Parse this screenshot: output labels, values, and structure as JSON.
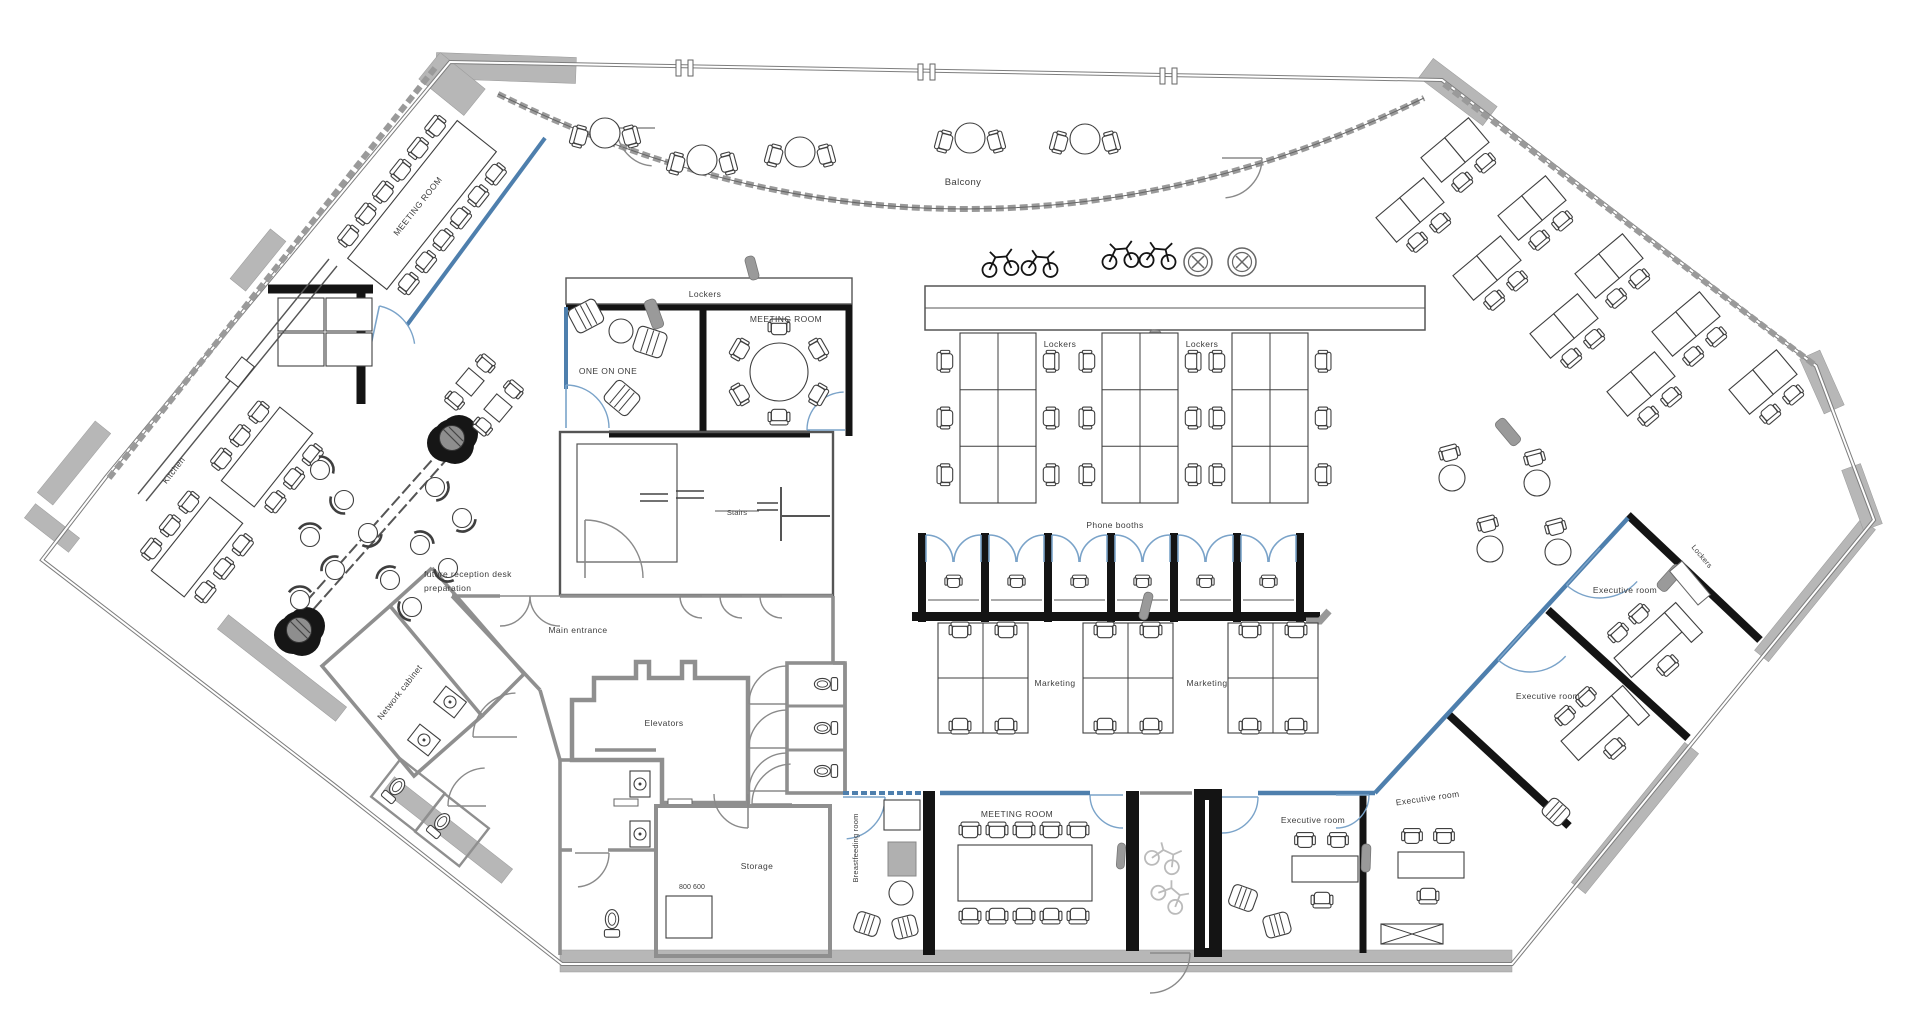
{
  "title": "Office floor plan",
  "colors": {
    "glass_blue": "#4e7fad",
    "door_arc_blue": "#7aa3c9",
    "door_arc_gray": "#8a8a8a",
    "wall_black": "#141414",
    "wall_gray": "#8f8f8f",
    "band_gray": "#b7b7b7",
    "ink": "#3c3c3c"
  },
  "labels": {
    "meeting_room_nw": "MEETING ROOM",
    "balcony": "Balcony",
    "lockers_top": "Lockers",
    "meeting_room_center": "MEETING ROOM",
    "one_on_one": "ONE ON ONE",
    "lockers_mid_left": "Lockers",
    "lockers_mid_right": "Lockers",
    "kitchen": "Kitchen",
    "future_reception_line1": "future reception desk",
    "future_reception_line2": "preparation",
    "main_entrance": "Main entrance",
    "stairs": "Stairs",
    "phone_booths": "Phone booths",
    "marketing_left": "Marketing",
    "marketing_right": "Marketing",
    "network_cabinet": "Network cabinet",
    "elevators": "Elevators",
    "storage": "Storage",
    "storage_note": "800 600",
    "breastfeeding_room": "Breastfeeding room",
    "meeting_room_south": "MEETING ROOM",
    "executive_south_left": "Executive room",
    "executive_south_right": "Executive room",
    "executive_east_mid": "Executive room",
    "executive_east_top": "Executive room",
    "lockers_east": "Lockers"
  }
}
